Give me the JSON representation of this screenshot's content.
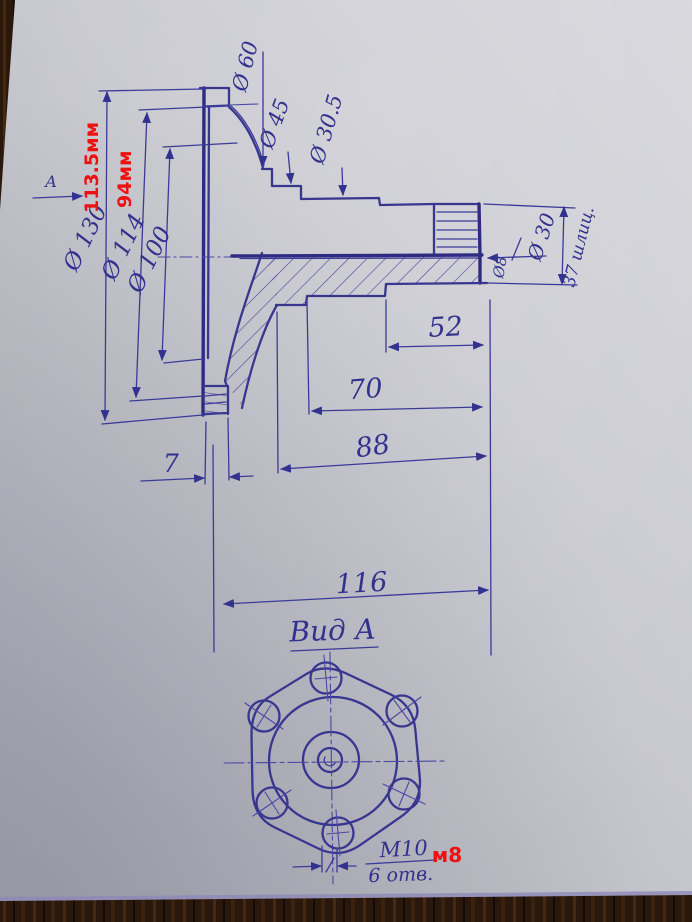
{
  "labels": {
    "view_arrow_letter": "А",
    "dia_130": "Ø 130",
    "dia_114": "Ø 114",
    "dia_100": "Ø 100",
    "dia_60": "Ø 60",
    "dia_45": "Ø 45",
    "dia_30_5": "Ø 30.5",
    "dia_30": "Ø 30",
    "dia_8": "Ø8",
    "splines": "37 шлиц.",
    "len_52": "52",
    "len_70": "70",
    "len_88": "88",
    "len_7": "7",
    "len_116": "116",
    "bottom_view_title": "Вид А",
    "thread": "М10",
    "holes_count": "6 отв."
  },
  "red_annotations": {
    "flange_diameter": "113.5мм",
    "bolt_circle_diameter": "94мм",
    "thread_correction": "м8"
  },
  "colors": {
    "pen_blue": "#3c3a98",
    "annotation_red": "#ee1111",
    "paper_gray": "#c6c6cd",
    "wood_brown": "#2a180c"
  }
}
